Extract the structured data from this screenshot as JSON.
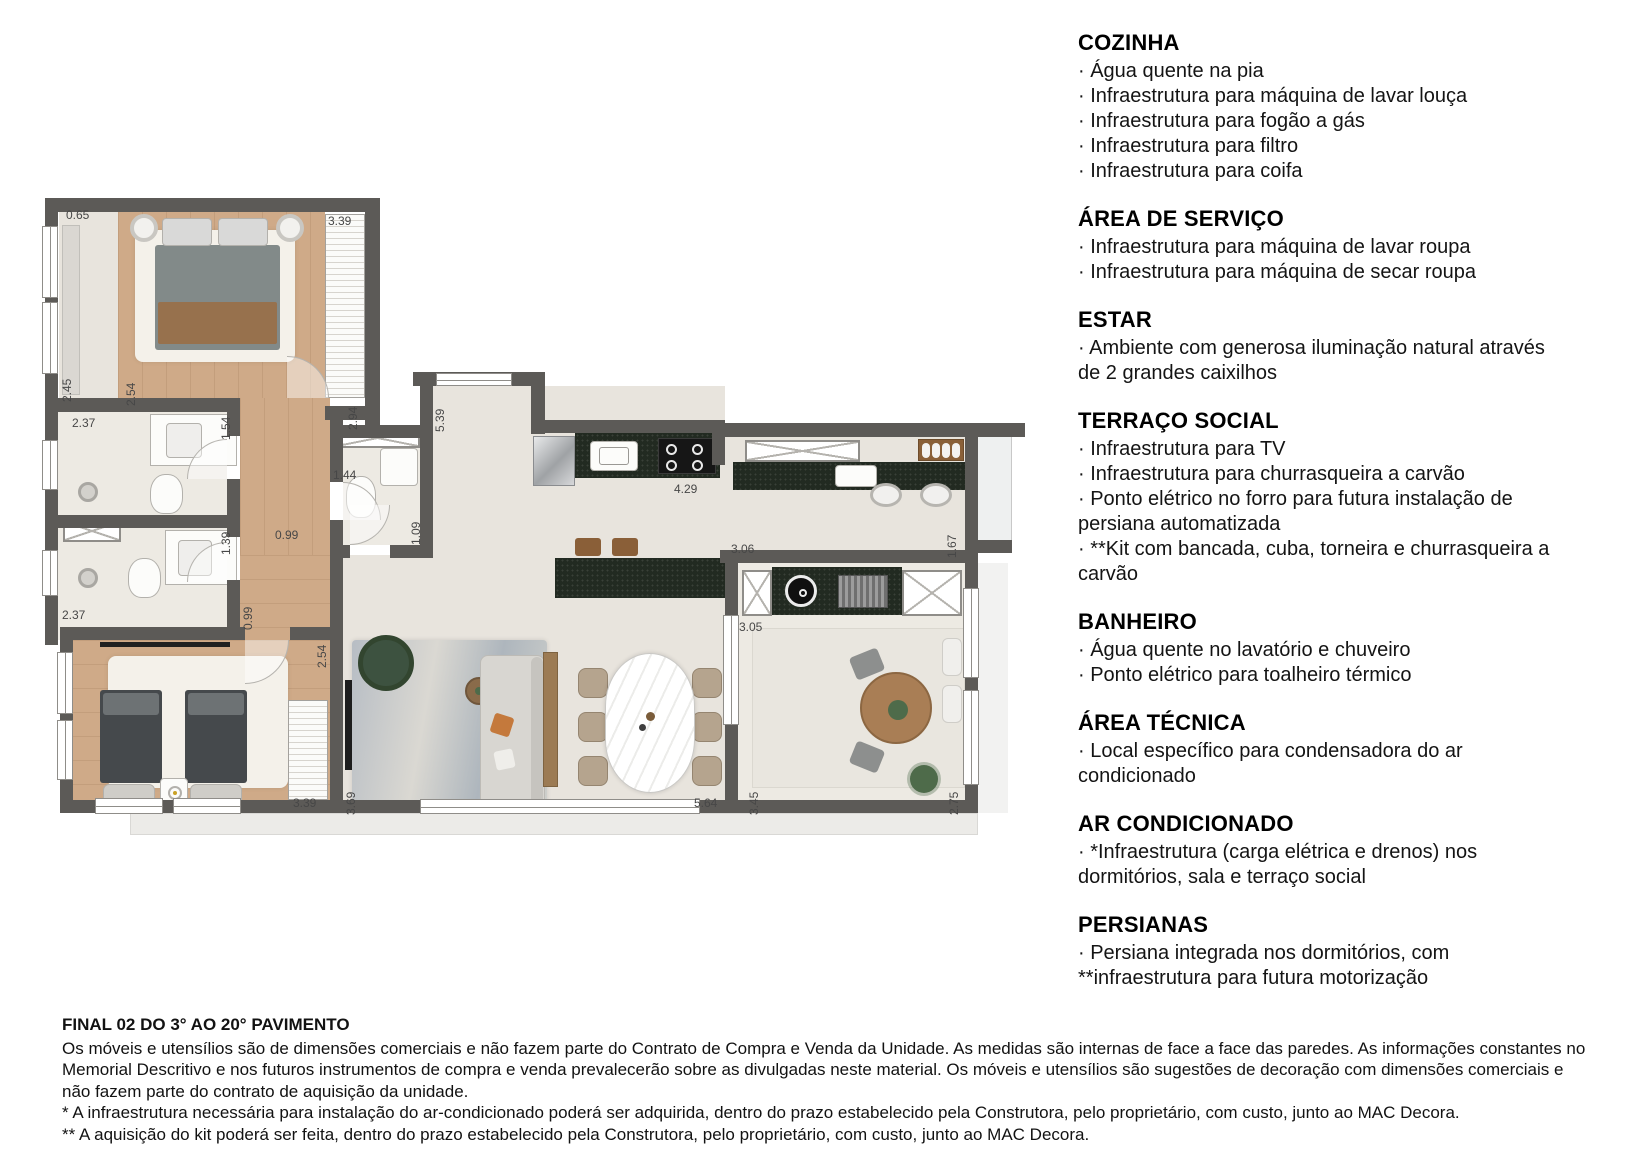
{
  "specs": {
    "sections": [
      {
        "title": "COZINHA",
        "items": [
          "· Água quente na pia",
          "· Infraestrutura para máquina de lavar louça",
          "· Infraestrutura para fogão a gás",
          "· Infraestrutura para filtro",
          "· Infraestrutura para coifa"
        ]
      },
      {
        "title": "ÁREA DE SERVIÇO",
        "items": [
          "· Infraestrutura para máquina de lavar roupa",
          "· Infraestrutura para máquina de secar roupa"
        ]
      },
      {
        "title": "ESTAR",
        "items": [
          "· Ambiente com generosa iluminação natural através de 2 grandes caixilhos"
        ]
      },
      {
        "title": "TERRAÇO SOCIAL",
        "items": [
          "· Infraestrutura para TV",
          "· Infraestrutura para churrasqueira a carvão",
          "· Ponto elétrico no forro para futura instalação de persiana automatizada",
          "· **Kit com bancada, cuba, torneira e churrasqueira a carvão"
        ]
      },
      {
        "title": "BANHEIRO",
        "items": [
          "· Água quente no lavatório e chuveiro",
          "· Ponto elétrico para toalheiro térmico"
        ]
      },
      {
        "title": "ÁREA TÉCNICA",
        "items": [
          "· Local específico para condensadora do ar condicionado"
        ]
      },
      {
        "title": "AR CONDICIONADO",
        "items": [
          "· *Infraestrutura (carga elétrica e drenos) nos dormitórios, sala e terraço social"
        ]
      },
      {
        "title": "PERSIANAS",
        "items": [
          "· Persiana integrada nos dormitórios, com **infraestrutura para futura motorização"
        ]
      }
    ]
  },
  "footer": {
    "title": "FINAL 02 DO 3° AO 20° PAVIMENTO",
    "disclaimer": "Os móveis e utensílios são de dimensões comerciais e não fazem parte do Contrato de Compra e Venda da Unidade. As medidas são internas de face a face das paredes. As informações constantes no Memorial Descritivo e nos futuros instrumentos de compra e venda prevalecerão sobre as divulgadas neste material. Os móveis e utensílios são sugestões de decoração com dimensões comerciais e não fazem parte do contrato de aquisição da unidade.",
    "note1": "* A infraestrutura necessária para instalação do ar-condicionado poderá ser adquirida, dentro do prazo estabelecido pela Construtora, pelo proprietário, com custo, junto ao MAC Decora.",
    "note2": "** A aquisição do kit poderá ser feita, dentro do prazo estabelecido pela Construtora, pelo proprietário, com custo, junto ao MAC Decora."
  },
  "floorplan": {
    "dimensions": [
      {
        "v": "0.65",
        "x": 26,
        "y": 18,
        "o": "h"
      },
      {
        "v": "3.39",
        "x": 288,
        "y": 24,
        "o": "h"
      },
      {
        "v": "2.45",
        "x": 20,
        "y": 212,
        "o": "v"
      },
      {
        "v": "2.54",
        "x": 84,
        "y": 216,
        "o": "v"
      },
      {
        "v": "2.37",
        "x": 32,
        "y": 226,
        "o": "h"
      },
      {
        "v": "1.54",
        "x": 179,
        "y": 250,
        "o": "v"
      },
      {
        "v": "2.94",
        "x": 306,
        "y": 240,
        "o": "v"
      },
      {
        "v": "5.39",
        "x": 393,
        "y": 242,
        "o": "v"
      },
      {
        "v": "1.44",
        "x": 293,
        "y": 278,
        "o": "h"
      },
      {
        "v": "1.09",
        "x": 369,
        "y": 355,
        "o": "v"
      },
      {
        "v": "0.99",
        "x": 235,
        "y": 338,
        "o": "h"
      },
      {
        "v": "1.39",
        "x": 179,
        "y": 365,
        "o": "v"
      },
      {
        "v": "0.99",
        "x": 201,
        "y": 440,
        "o": "v"
      },
      {
        "v": "2.37",
        "x": 22,
        "y": 418,
        "o": "h"
      },
      {
        "v": "2.54",
        "x": 275,
        "y": 478,
        "o": "v"
      },
      {
        "v": "3.39",
        "x": 253,
        "y": 606,
        "o": "h"
      },
      {
        "v": "3.69",
        "x": 304,
        "y": 625,
        "o": "v"
      },
      {
        "v": "4.29",
        "x": 634,
        "y": 292,
        "o": "h"
      },
      {
        "v": "3.06",
        "x": 691,
        "y": 352,
        "o": "h"
      },
      {
        "v": "1.67",
        "x": 905,
        "y": 368,
        "o": "v"
      },
      {
        "v": "3.05",
        "x": 699,
        "y": 430,
        "o": "h"
      },
      {
        "v": "5.64",
        "x": 654,
        "y": 606,
        "o": "h"
      },
      {
        "v": "3.45",
        "x": 707,
        "y": 625,
        "o": "v"
      },
      {
        "v": "2.75",
        "x": 907,
        "y": 625,
        "o": "v"
      }
    ]
  }
}
